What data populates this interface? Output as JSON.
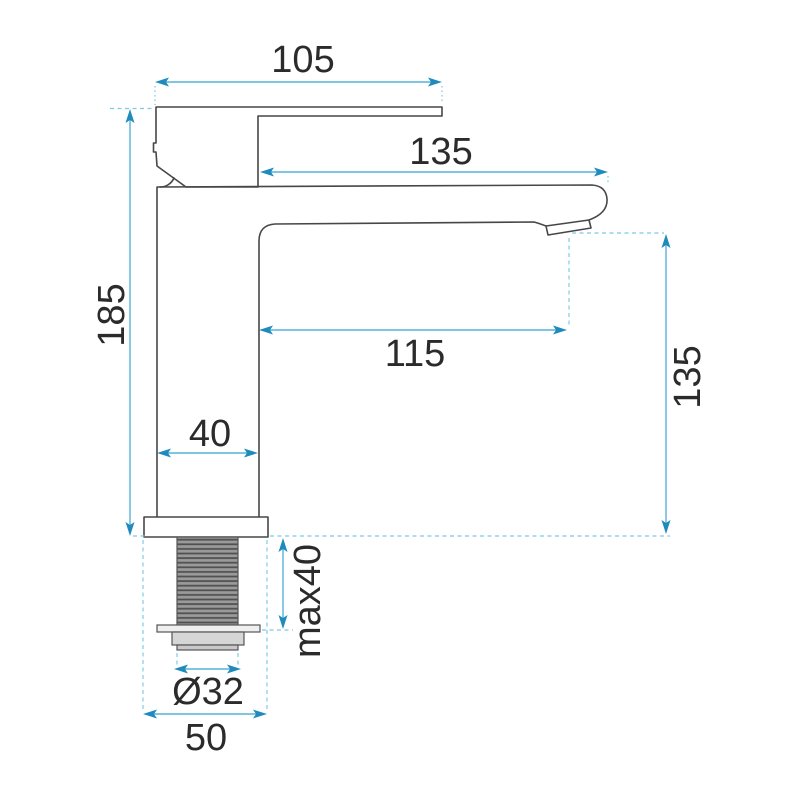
{
  "page": {
    "background": "#ffffff"
  },
  "diagram": {
    "type": "technical-dimension-drawing",
    "subject": "single-lever basin mixer faucet, side view",
    "units_implied": "mm",
    "colors": {
      "outline": "#474747",
      "dimension_line": "#55b4da",
      "arrowhead": "#1f8abc",
      "extension_line": "#7ecbe4",
      "text": "#2b2b2b",
      "thread_fill": "#9a9a9a",
      "thread_stripe": "#515151",
      "nut_fill": "#d6d6d6"
    },
    "dimensions": {
      "handle_width_top": "105",
      "spout_length_overall": "135",
      "overall_height": "185",
      "spout_reach": "115",
      "body_width": "40",
      "max_mounting_thickness": "max40",
      "outlet_height": "135",
      "shank_diameter": "Ø32",
      "base_width": "50"
    }
  }
}
